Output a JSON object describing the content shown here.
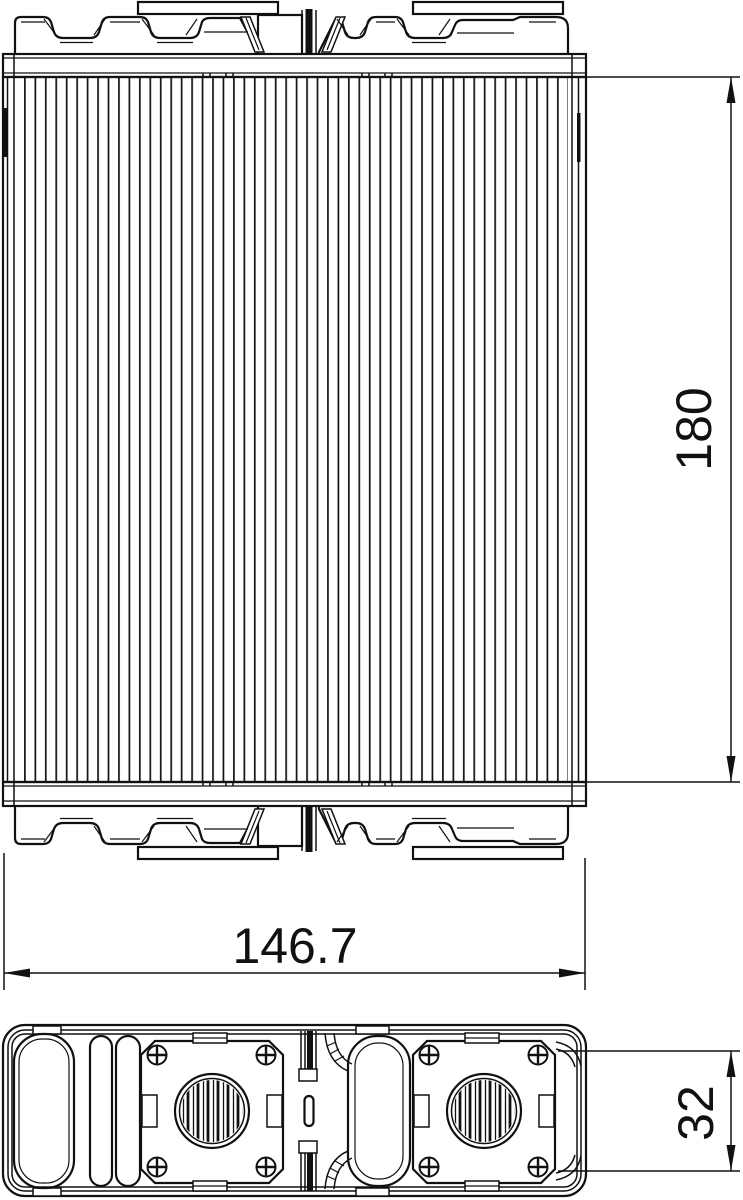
{
  "dimensions": {
    "core_height": "180",
    "core_width": "146.7",
    "tank_depth": "32"
  },
  "colors": {
    "line": "#111111",
    "background": "#ffffff"
  }
}
